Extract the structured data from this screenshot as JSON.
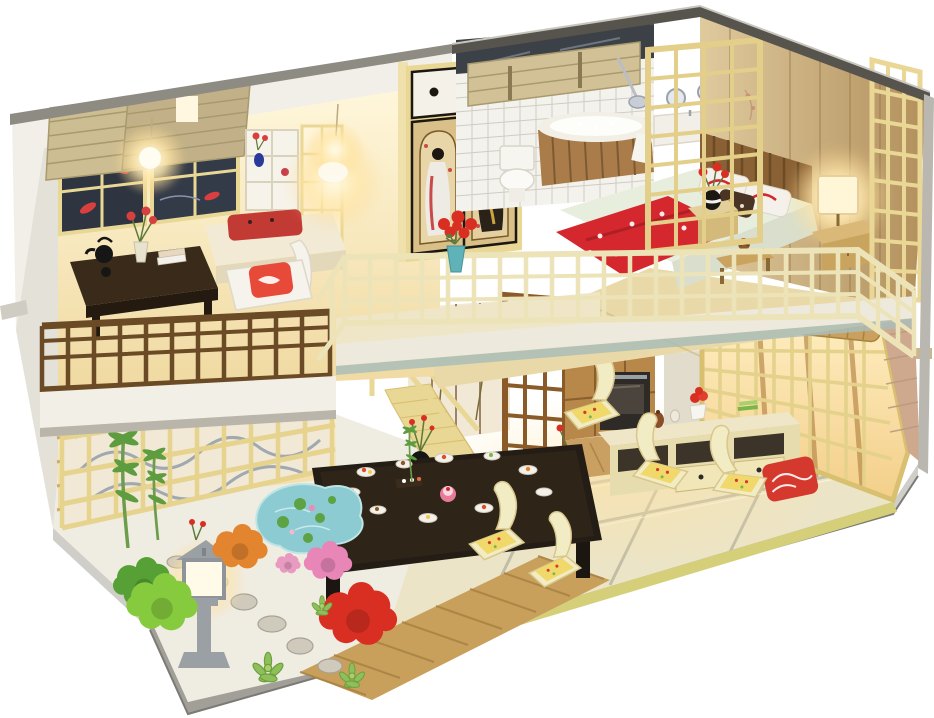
{
  "meta": {
    "type": "product-photo",
    "subject": "DIY miniature dollhouse diorama — two-story Japanese-style home with lit interiors, open cutaway front, mounted on a gray base against a white studio background"
  },
  "palette": {
    "white_bg": "#ffffff",
    "wall_white": "#f2efe8",
    "wall_shade": "#e4e1d9",
    "base_side": "#a19f98",
    "base_light": "#cfcec8",
    "roof_dark": "#57544e",
    "trim_gray": "#8e8b83",
    "wood_pale": "#e9d795",
    "wood_gold": "#d9bf6e",
    "wood_mid": "#b8884a",
    "wood_dark": "#6b4a26",
    "wood_deck": "#c8a05c",
    "garden_paving": "#efece2",
    "tatami": "#ece4c6",
    "tatami_edge": "#d6cf7a",
    "shoji_cream": "#f1e9d6",
    "tile_white": "#f4f2ed",
    "panel_hi": "#dfca9e",
    "panel_lo": "#b2905c",
    "plank_pink": "#cfa98d",
    "bed_red": "#d5282e",
    "bed_mint": "#e7eede",
    "pond_teal": "#8ccbd1",
    "bush_green": "#86ca3e",
    "bush_red": "#d92f23",
    "bush_pink": "#e886b8",
    "bush_orange": "#e2852e",
    "lantern_gray": "#9aa0a4",
    "teal_accent": "#5fb3b8",
    "cushion_yellow": "#f0d96a",
    "glow_warm": "#ffd98f"
  },
  "scene": {
    "background": "white studio sweep",
    "base": "gray display platform with beveled front edges",
    "exterior": {
      "left_wall": "white exterior side wall",
      "roof": "dark-trimmed flat roof edges",
      "right_wall": "pink-tan plank corner with gray edge"
    },
    "upper_floor": {
      "tea_room": [
        "bamboo window blinds",
        "dark koi-print window panes",
        "hanging bulb light",
        "glowing wall lamp",
        "display shelf with blue vase and red flowers",
        "dark tea table with black teapot, red flowers and magazines",
        "white chair with red koi cushion",
        "window bench with red cushion",
        "dark wood balcony railing",
        "paper shade lamp on landing"
      ],
      "wardrobe": "sliding-door closet with two geisha ukiyo-e prints and black round pulls",
      "bathroom": [
        "white tiled wall",
        "rolled bamboo blind",
        "silver shower",
        "wooden barrel bathtub with white rim",
        "toilet",
        "vanity with round mirrors",
        "tall yellow lattice screen"
      ],
      "bedroom": [
        "slatted wood headboard",
        "mint floral bedding",
        "red blossom blanket",
        "white-and-red pillows",
        "dark patterned pillow",
        "nightstand with black-striped vase of red flowers",
        "glowing bedside lamp on nightstand",
        "foot stool with pinecone",
        "pale yellow lattice screen",
        "beige paneled back wall"
      ],
      "balcony": [
        "cream lattice railing",
        "teal vase with red bouquet"
      ]
    },
    "ground_floor": {
      "living_room": [
        "woven tatami mats with dark borders",
        "low black dining table set with sushi plates and a pink cake",
        "five yellow legless floor chairs with floral cushions",
        "red patterned cushion",
        "cream sideboard with jars, potted red flower and green books",
        "lattice window wall with rolled bamboo blind"
      ],
      "kitchen": [
        "wood cabinets",
        "black built-in oven",
        "white counter with green fruit and a pan",
        "plank wood floor"
      ],
      "hall": [
        "lotus-painted shoji panels",
        "dark wood lattice partition",
        "staircase with pale railing",
        "black vase with red sprigs",
        "brass vase of flowers"
      ],
      "garden": [
        "glowing stone lantern",
        "koi pond with lily pads",
        "stepping stones",
        "wood deck walkway",
        "bamboo plants",
        "green shrub",
        "red shrub",
        "pink hydrangea",
        "orange chrysanthemum",
        "succulents",
        "lattice fence backed by a wave mural"
      ]
    }
  }
}
